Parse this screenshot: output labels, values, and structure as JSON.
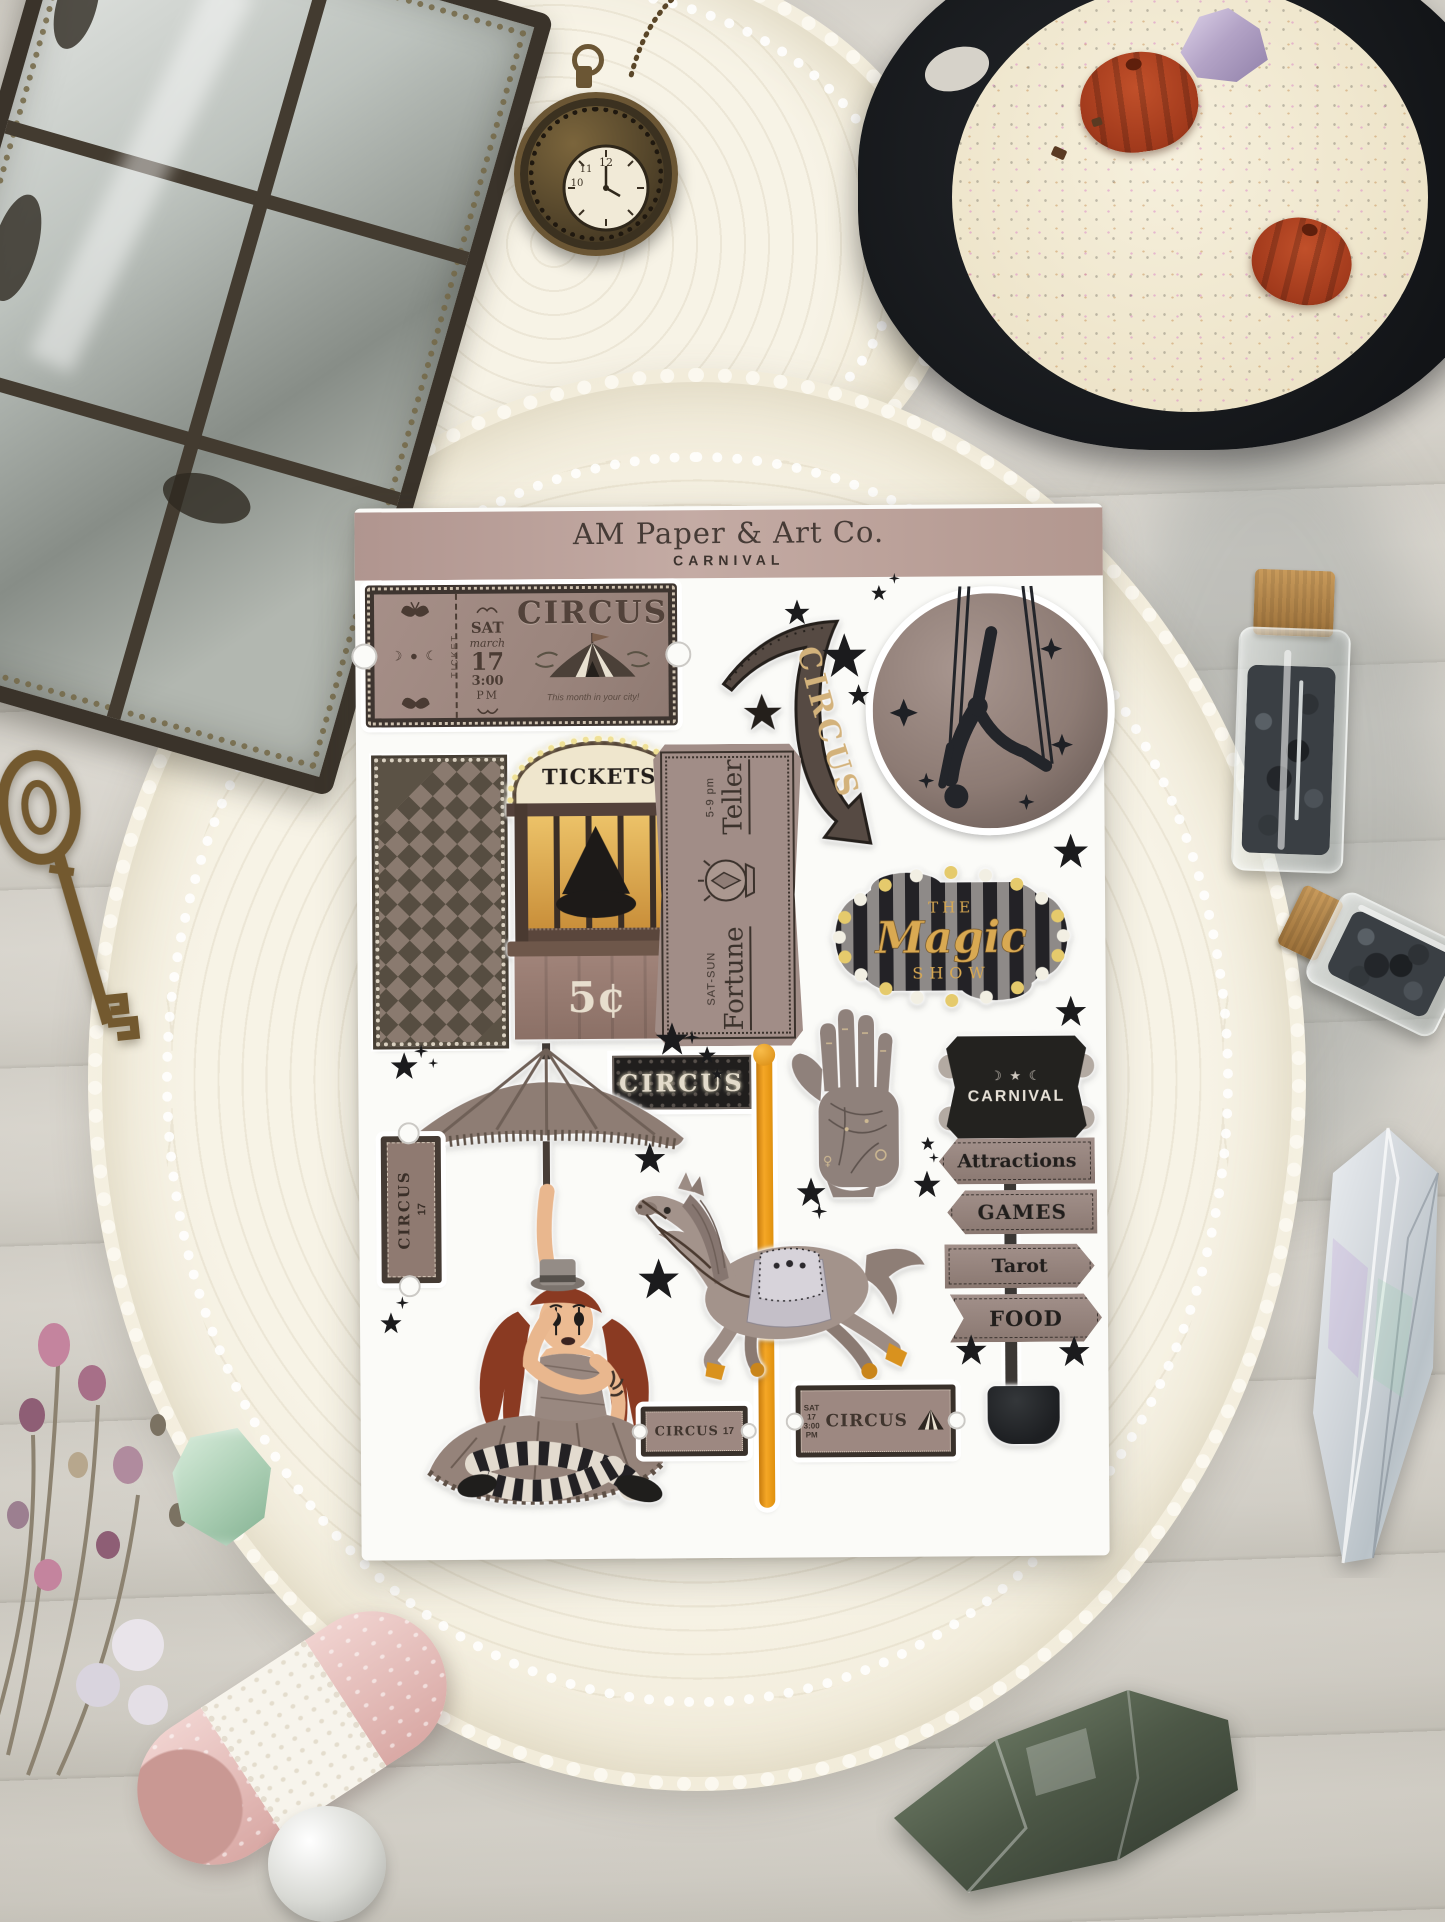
{
  "header": {
    "brand": "AM Paper & Art Co.",
    "collection": "CARNIVAL"
  },
  "stickers": {
    "large_ticket": {
      "stub": "TICKET",
      "moons": "☽ ● ☾",
      "day": "SAT",
      "month": "march",
      "date": "17",
      "time": "3:00",
      "meridiem": "PM",
      "title": "CIRCUS",
      "tagline": "This month in your city!"
    },
    "arrow_sign": {
      "label": "CIRCUS"
    },
    "ticket_booth": {
      "marquee": "TICKETS",
      "price": "5¢"
    },
    "fortune_plaque": {
      "word1": "Fortune",
      "word2": "Teller",
      "days": "SAT-SUN",
      "hours": "5-9 pm"
    },
    "magic_marquee": {
      "line1": "THE",
      "line2": "Magic",
      "line3": "SHOW"
    },
    "circus_banner": {
      "label": "CIRCUS"
    },
    "signpost": {
      "title": "CARNIVAL",
      "moons": "☽ ★ ☾",
      "arrows": [
        "Attractions",
        "GAMES",
        "Tarot",
        "FOOD"
      ]
    },
    "vertical_ticket": {
      "title": "CIRCUS",
      "date": "17"
    },
    "mini_ticket_a": {
      "title": "CIRCUS",
      "date": "17"
    },
    "mini_ticket_b": {
      "title": "CIRCUS",
      "day": "SAT",
      "date": "17",
      "time": "3:00",
      "meridiem": "PM"
    },
    "palm_hand": {
      "symbol": "♀"
    }
  },
  "watch": {
    "numerals": [
      "12",
      "11",
      "10"
    ]
  },
  "palette": {
    "sheet": "#fbfbf8",
    "band": "#b89d96",
    "band_text": "#463b36",
    "ticket_paper": "#a28c85",
    "ticket_border": "#3e3530",
    "ink": "#3b322c",
    "gold": "#d9a952",
    "pole_orange": "#f5a726",
    "marquee_cream": "#efe6cd",
    "bulb_yellow": "#efe096",
    "stripe_black": "#232226",
    "stripe_gray": "#8e8a88",
    "wood_sign": "#9c8a83",
    "star_black": "#1b1b1d",
    "doily": "#f4efe1",
    "wood_table": "#d6d2c9",
    "iron_black": "#17191c",
    "wax_cream": "#f2ecd8",
    "pumpkin_red": "#a84020",
    "amethyst": "#b3a3c6",
    "brass": "#6b5634",
    "hair_auburn": "#8a3a22",
    "skin": "#ecbb92",
    "mint_gem": "#a9cdb2",
    "pink_lace": "#e9c6c4",
    "crystal_green": "#5d6b52"
  }
}
